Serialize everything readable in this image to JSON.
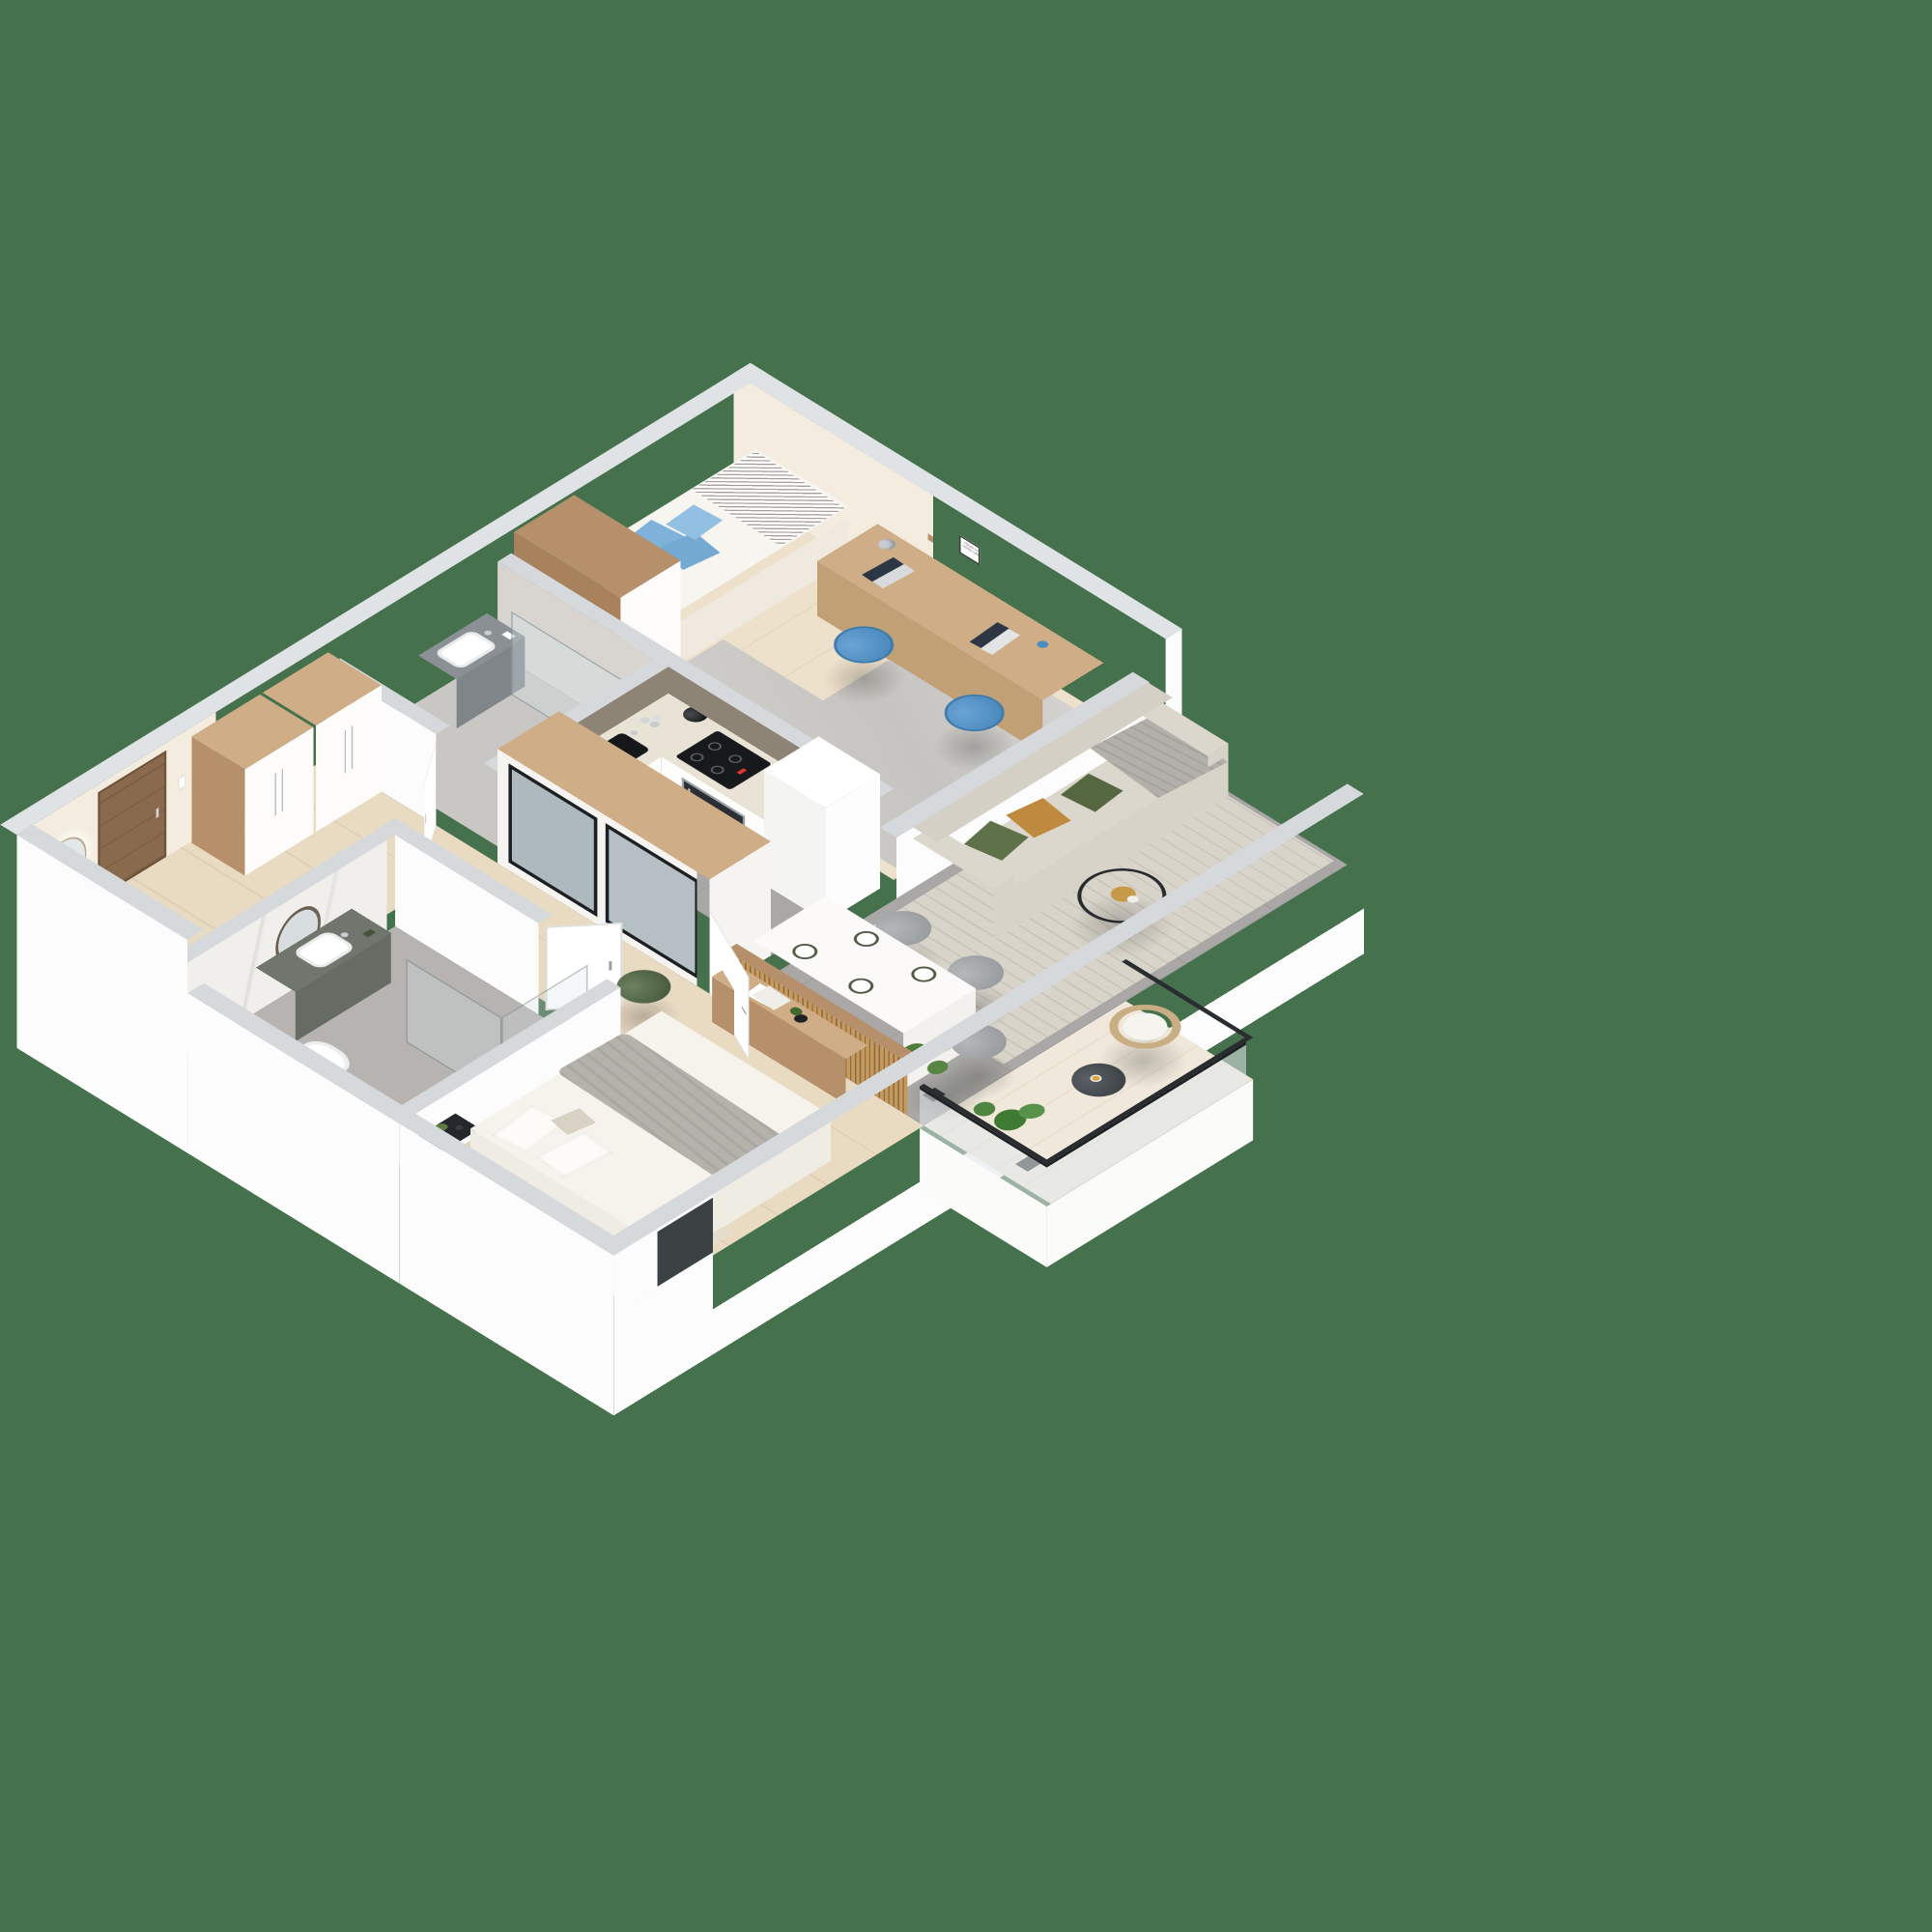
{
  "scene": {
    "type": "isometric-3d-floor-plan-render",
    "background_color": "#46714d",
    "frame_text": "TODAY IS GOOD DAY",
    "palette": {
      "wall_top": "#d6d9dc",
      "wall_face": "#fcfcfc",
      "interior_cream": "#f3ecdf",
      "backsplash_taupe": "#8e8476",
      "wood": "#b68f6b",
      "floor_wood": "#e9dac2",
      "floor_tile": "#a9a8a6",
      "sofa": "#dcd7cc",
      "pillow_green": "#5e7148",
      "pillow_mustard": "#c08a3e",
      "pillow_blue": "#7fb2d8",
      "chair_blue": "#4d8cc0",
      "accent_red": "#c0392b",
      "accent_yellow": "#d4ac2b"
    },
    "rooms": [
      {
        "name": "hallway",
        "items": [
          "entrance-door",
          "backlit-round-mirror",
          "console-shelf",
          "wardrobe-run",
          "intercom"
        ]
      },
      {
        "name": "wc-bathroom",
        "items": [
          "wall-hung-toilet",
          "gray-vanity-with-sink",
          "round-mirror",
          "glass-shower-screen",
          "chrome-shower-column"
        ]
      },
      {
        "name": "kids-room",
        "items": [
          "single-bed",
          "blue-pillows",
          "chevron-throw",
          "captain-america-poster",
          "wood-wardrobe",
          "desk",
          "laptop",
          "laptop",
          "desk-lamp",
          "blue-office-chair",
          "blue-office-chair",
          "wall-shelves",
          "motivational-frame",
          "gray-rug",
          "floor-pillow"
        ]
      },
      {
        "name": "kitchen",
        "items": [
          "white-cabinets",
          "black-sink",
          "chrome-faucet",
          "glass-set",
          "black-kettle",
          "induction-hob",
          "built-in-oven",
          "tall-cabinet-column",
          "taupe-backsplash"
        ]
      },
      {
        "name": "living-dining",
        "items": [
          "beige-sofa",
          "green-pillows",
          "mustard-pillows",
          "gray-throw",
          "wire-coffee-table",
          "dried-gold-plant",
          "dining-table",
          "plates",
          "gray-chairs",
          "monstera-plant",
          "striped-rug",
          "wood-slat-partition"
        ]
      },
      {
        "name": "bedroom",
        "items": [
          "double-bed",
          "white-pillows",
          "gray-throw",
          "black-nightstand",
          "vase-with-plant",
          "beige-rug",
          "slat-sideboard",
          "notebooks",
          "black-vase",
          "mirrored-wardrobe",
          "open-white-door",
          "green-pouf"
        ]
      },
      {
        "name": "master-bathroom",
        "items": [
          "round-mirror",
          "green-gray-vanity",
          "white-sink",
          "wall-hung-toilet",
          "glass-shower",
          "marble-tiles"
        ]
      },
      {
        "name": "balcony",
        "items": [
          "rattan-chair",
          "white-cushion",
          "round-side-table",
          "drink-glass",
          "potted-plants",
          "glass-railing"
        ]
      }
    ]
  }
}
